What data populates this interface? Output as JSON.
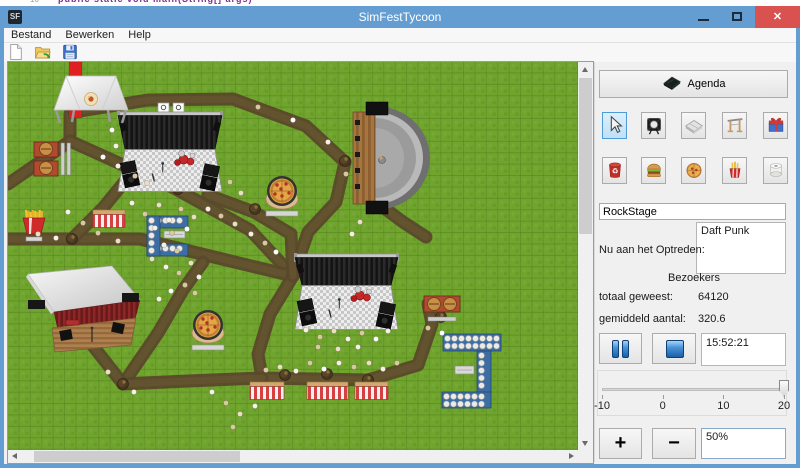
{
  "background": {
    "code_fragment": "public static void main(String[] args)",
    "line_number": "10"
  },
  "window": {
    "title": "SimFestTycoon",
    "icon_text": "SF",
    "controls": {
      "close_glyph": "✕"
    }
  },
  "menu": {
    "items": [
      "Bestand",
      "Bewerken",
      "Help"
    ]
  },
  "toolbar": {
    "buttons": [
      {
        "name": "new"
      },
      {
        "name": "open"
      },
      {
        "name": "save"
      }
    ]
  },
  "panel": {
    "agenda_button": {
      "label": "Agenda",
      "icon": "notebook-icon"
    },
    "tool_buttons_row1": [
      {
        "icon": "cursor",
        "name": "select-tool-button",
        "selected": true
      },
      {
        "icon": "spotlight",
        "name": "spotlight-tool-button",
        "selected": false
      },
      {
        "icon": "platform",
        "name": "stage-platform-tool-button",
        "selected": false
      },
      {
        "icon": "scaffold",
        "name": "scaffold-tool-button",
        "selected": false
      },
      {
        "icon": "gift",
        "name": "gift-shop-tool-button",
        "selected": false
      }
    ],
    "tool_buttons_row2": [
      {
        "icon": "trash",
        "name": "trash-tool-button",
        "selected": false
      },
      {
        "icon": "burger",
        "name": "burger-stand-tool-button",
        "selected": false
      },
      {
        "icon": "pizza",
        "name": "pizza-stand-tool-button",
        "selected": false
      },
      {
        "icon": "fries",
        "name": "fries-stand-tool-button",
        "selected": false
      },
      {
        "icon": "roll",
        "name": "toilet-tool-button",
        "selected": false
      }
    ],
    "stage_name_field": {
      "value": "RockStage"
    },
    "now_performing": {
      "label": "Nu aan het Optreden:",
      "value": "Daft Punk"
    },
    "visitors": {
      "header": "Bezoekers",
      "rows": [
        {
          "label": "totaal geweest:",
          "value": "64120"
        },
        {
          "label": "gemiddeld aantal:",
          "value": "320.6"
        }
      ]
    },
    "playback": {
      "time": "15:52:21"
    },
    "speed_slider": {
      "min": -10,
      "max": 20,
      "value": 20,
      "ticks": [
        "-10",
        "0",
        "10",
        "20"
      ]
    },
    "zoom": {
      "plus": "+",
      "minus": "−",
      "level": "50%"
    }
  },
  "map": {
    "grass_color": "#6fa42d",
    "path_color": "#5a492b",
    "paths": [
      [
        [
          0,
          122
        ],
        [
          62,
          79
        ],
        [
          62,
          52
        ]
      ],
      [
        [
          62,
          79
        ],
        [
          166,
          126
        ],
        [
          242,
          168
        ],
        [
          285,
          214
        ]
      ],
      [
        [
          0,
          177
        ],
        [
          132,
          177
        ],
        [
          210,
          196
        ],
        [
          285,
          214
        ]
      ],
      [
        [
          64,
          177
        ],
        [
          95,
          146
        ],
        [
          122,
          113
        ]
      ],
      [
        [
          66,
          50
        ],
        [
          140,
          38
        ],
        [
          225,
          37
        ],
        [
          298,
          64
        ],
        [
          337,
          100
        ]
      ],
      [
        [
          337,
          100
        ],
        [
          328,
          140
        ],
        [
          300,
          170
        ],
        [
          285,
          214
        ]
      ],
      [
        [
          285,
          214
        ],
        [
          262,
          252
        ],
        [
          250,
          292
        ],
        [
          254,
          316
        ],
        [
          360,
          318
        ]
      ],
      [
        [
          360,
          318
        ],
        [
          410,
          303
        ],
        [
          424,
          262
        ],
        [
          420,
          242
        ]
      ],
      [
        [
          115,
          322
        ],
        [
          150,
          271
        ],
        [
          175,
          228
        ],
        [
          195,
          200
        ]
      ],
      [
        [
          115,
          322
        ],
        [
          85,
          284
        ]
      ],
      [
        [
          115,
          322
        ],
        [
          180,
          319
        ],
        [
          254,
          316
        ]
      ],
      [
        [
          200,
          133
        ],
        [
          246,
          150
        ],
        [
          283,
          172
        ],
        [
          285,
          214
        ]
      ],
      [
        [
          368,
          140
        ],
        [
          395,
          160
        ],
        [
          418,
          175
        ]
      ]
    ],
    "red_carpet": {
      "x": 61,
      "y": 0,
      "w": 13,
      "h": 56
    },
    "tent": {
      "x": 46,
      "y": 14,
      "w": 74,
      "h": 34
    },
    "stages": [
      {
        "x": 110,
        "y": 50,
        "w": 104,
        "curtain": 34,
        "floor": 42,
        "signs": true
      },
      {
        "x": 287,
        "y": 192,
        "w": 103,
        "curtain": 28,
        "floor": 44,
        "signs": false
      }
    ],
    "amphitheater": {
      "deck_x": 345,
      "deck_y": 50,
      "deck_w": 22,
      "deck_h": 92,
      "cx": 367,
      "cy": 96
    },
    "barn": {
      "x": 20,
      "y": 204,
      "w": 112,
      "h": 86
    },
    "pizza_stands": [
      {
        "cx": 274,
        "cy": 130
      },
      {
        "cx": 200,
        "cy": 264
      }
    ],
    "burger_stands": [
      {
        "x": 26,
        "y": 80,
        "vertical": true
      },
      {
        "x": 416,
        "y": 234,
        "vertical": false
      }
    ],
    "fries_stand": {
      "x": 10,
      "y": 144
    },
    "striped_stalls": [
      {
        "x": 85,
        "y": 148,
        "w": 32
      },
      {
        "x": 242,
        "y": 320,
        "w": 34
      },
      {
        "x": 299,
        "y": 320,
        "w": 41
      },
      {
        "x": 347,
        "y": 320,
        "w": 33
      }
    ],
    "toilets": [
      {
        "x": 435,
        "y": 272,
        "w": 58,
        "h": 17
      },
      {
        "x": 469,
        "y": 289,
        "w": 14,
        "h": 42
      },
      {
        "x": 434,
        "y": 330,
        "w": 49,
        "h": 16
      },
      {
        "x": 139,
        "y": 154,
        "w": 41,
        "h": 12
      },
      {
        "x": 139,
        "y": 182,
        "w": 41,
        "h": 12
      },
      {
        "x": 139,
        "y": 154,
        "w": 13,
        "h": 40
      }
    ],
    "benches": [
      {
        "x": 447,
        "y": 304,
        "w": 19,
        "h": 8
      },
      {
        "x": 156,
        "y": 169,
        "w": 21,
        "h": 7
      }
    ],
    "trees": [
      [
        170,
        127
      ],
      [
        64,
        177
      ],
      [
        115,
        322
      ],
      [
        296,
        199
      ],
      [
        337,
        99
      ],
      [
        277,
        313
      ],
      [
        319,
        312
      ],
      [
        247,
        147
      ],
      [
        433,
        255
      ],
      [
        360,
        318
      ]
    ],
    "people": [
      [
        95,
        95
      ],
      [
        110,
        104
      ],
      [
        127,
        114
      ],
      [
        139,
        121
      ],
      [
        200,
        147
      ],
      [
        213,
        154
      ],
      [
        227,
        162
      ],
      [
        243,
        172
      ],
      [
        257,
        181
      ],
      [
        268,
        190
      ],
      [
        124,
        141
      ],
      [
        137,
        152
      ],
      [
        151,
        143
      ],
      [
        161,
        158
      ],
      [
        173,
        147
      ],
      [
        186,
        155
      ],
      [
        147,
        166
      ],
      [
        164,
        171
      ],
      [
        179,
        167
      ],
      [
        156,
        183
      ],
      [
        169,
        189
      ],
      [
        144,
        197
      ],
      [
        158,
        205
      ],
      [
        171,
        211
      ],
      [
        183,
        201
      ],
      [
        191,
        215
      ],
      [
        177,
        223
      ],
      [
        163,
        229
      ],
      [
        151,
        237
      ],
      [
        187,
        231
      ],
      [
        30,
        172
      ],
      [
        48,
        176
      ],
      [
        90,
        171
      ],
      [
        110,
        179
      ],
      [
        60,
        150
      ],
      [
        75,
        161
      ],
      [
        104,
        68
      ],
      [
        108,
        84
      ],
      [
        222,
        120
      ],
      [
        233,
        131
      ],
      [
        298,
        268
      ],
      [
        312,
        275
      ],
      [
        326,
        269
      ],
      [
        340,
        277
      ],
      [
        354,
        271
      ],
      [
        368,
        277
      ],
      [
        380,
        269
      ],
      [
        310,
        285
      ],
      [
        330,
        287
      ],
      [
        350,
        285
      ],
      [
        258,
        308
      ],
      [
        272,
        305
      ],
      [
        288,
        309
      ],
      [
        302,
        301
      ],
      [
        316,
        307
      ],
      [
        331,
        301
      ],
      [
        346,
        305
      ],
      [
        361,
        301
      ],
      [
        375,
        307
      ],
      [
        389,
        301
      ],
      [
        352,
        160
      ],
      [
        344,
        172
      ],
      [
        420,
        266
      ],
      [
        434,
        271
      ],
      [
        204,
        330
      ],
      [
        218,
        341
      ],
      [
        232,
        352
      ],
      [
        247,
        344
      ],
      [
        225,
        365
      ],
      [
        100,
        310
      ],
      [
        126,
        330
      ],
      [
        250,
        45
      ],
      [
        285,
        58
      ],
      [
        320,
        80
      ],
      [
        338,
        112
      ]
    ]
  },
  "colors": {
    "titlebar": "#649dd1",
    "close_button": "#da5250",
    "selected_tool_border": "#4f9bd5",
    "panel_bg": "#f0f0f0"
  }
}
